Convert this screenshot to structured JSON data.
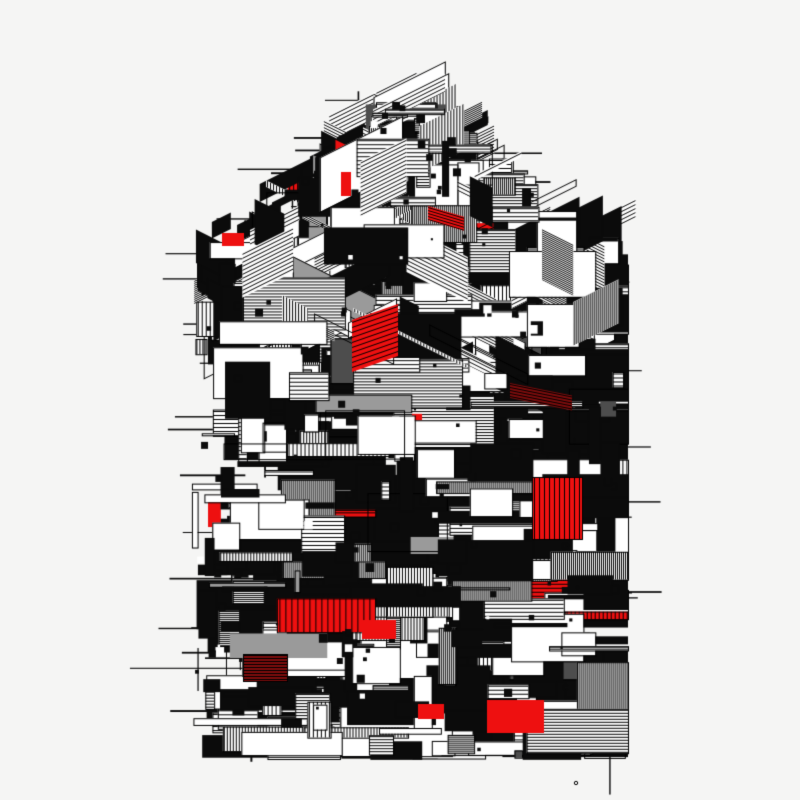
{
  "artwork": {
    "name": "generative-isometric-block-tower",
    "background": "#f5f5f4",
    "canvas": {
      "width": 800,
      "height": 800
    },
    "palette": {
      "black": "#0b0b0b",
      "white": "#ffffff",
      "red": "#ee1010",
      "dark_red": "#7e0d0d",
      "gray": "#9a9a9a",
      "dark_gray": "#4d4d4d",
      "line": "#000000"
    },
    "structure": {
      "center_x": 402,
      "apex_y": 88,
      "shoulder_y": 252,
      "bottom_y": 752,
      "max_half_width": 212,
      "top_slope": 1.35,
      "iso_section_end_y": 355,
      "iso_skew": 0.5
    },
    "counts": {
      "stray_lines": 170,
      "large_blacks": 80,
      "iso_shapes": 150,
      "main_rects": 620,
      "noise_squares": 120
    },
    "type_weights": {
      "solid_black": 0.34,
      "hatch_h": 0.2,
      "hatch_v": 0.1,
      "white_outline": 0.21,
      "gray": 0.05,
      "outline_only": 0.05,
      "red": 0.05
    },
    "hatch_spacings": [
      2,
      3,
      4
    ],
    "seed": 1337,
    "red_accents": [
      {
        "x": 352,
        "y": 320,
        "w": 46,
        "h": 52,
        "hatch": "h",
        "spacing": 5,
        "color": "red",
        "skew": -0.35
      },
      {
        "x": 532,
        "y": 477,
        "w": 50,
        "h": 62,
        "hatch": "v",
        "spacing": 5,
        "color": "red",
        "skew": 0
      },
      {
        "x": 487,
        "y": 700,
        "w": 57,
        "h": 33,
        "hatch": "none",
        "spacing": 0,
        "color": "red",
        "skew": 0
      },
      {
        "x": 362,
        "y": 620,
        "w": 34,
        "h": 19,
        "hatch": "none",
        "spacing": 0,
        "color": "red",
        "skew": 0
      },
      {
        "x": 222,
        "y": 233,
        "w": 22,
        "h": 13,
        "hatch": "none",
        "spacing": 0,
        "color": "red",
        "skew": 0
      },
      {
        "x": 341,
        "y": 172,
        "w": 10,
        "h": 24,
        "hatch": "none",
        "spacing": 0,
        "color": "red",
        "skew": 0
      },
      {
        "x": 428,
        "y": 206,
        "w": 36,
        "h": 14,
        "hatch": "h",
        "spacing": 3,
        "color": "red",
        "skew": 0.3
      },
      {
        "x": 243,
        "y": 654,
        "w": 44,
        "h": 27,
        "hatch": "h",
        "spacing": 3,
        "color": "dark_red",
        "skew": 0
      },
      {
        "x": 510,
        "y": 383,
        "w": 62,
        "h": 15,
        "hatch": "h",
        "spacing": 3,
        "color": "dark_red",
        "skew": 0.2
      },
      {
        "x": 418,
        "y": 704,
        "w": 26,
        "h": 15,
        "hatch": "none",
        "spacing": 0,
        "color": "red",
        "skew": 0
      }
    ],
    "stray_mark": {
      "x": 576,
      "y": 783,
      "r": 1.7
    }
  }
}
